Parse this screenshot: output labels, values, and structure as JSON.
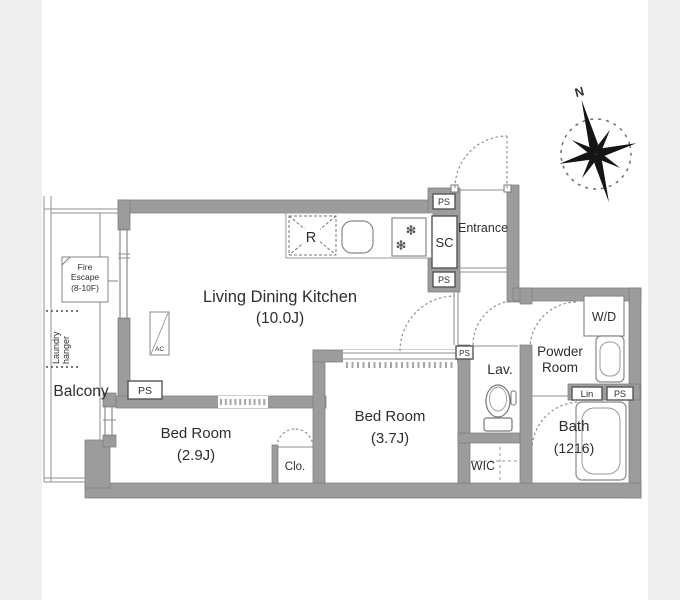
{
  "palette": {
    "page_background": "#efefef",
    "canvas_background": "#ffffff",
    "wall_gray": "#9c9c9c",
    "line_gray": "#8f8f8f",
    "text_color": "#2e2e2e"
  },
  "rooms": {
    "ldk": {
      "name": "Living Dining Kitchen",
      "size": "(10.0J)"
    },
    "bedroom_main": {
      "name": "Bed Room",
      "size": "(3.7J)"
    },
    "bedroom_second": {
      "name": "Bed Room",
      "size": "(2.9J)"
    },
    "bath": {
      "name": "Bath",
      "size": "(1216)"
    },
    "powder_room": {
      "line1": "Powder",
      "line2": "Room"
    },
    "lavatory": {
      "name": "Lav."
    },
    "walk_in_closet": {
      "name": "WIC"
    },
    "closet": {
      "name": "Clo."
    },
    "shoe_closet": {
      "name": "SC"
    },
    "entrance": {
      "name": "Entrance"
    },
    "balcony": {
      "name": "Balcony"
    }
  },
  "labels": {
    "pipe_space": "PS",
    "washer_dryer": "W/D",
    "refrigerator": "R",
    "air_conditioner": "AC",
    "linen": "Lin",
    "north": "N"
  },
  "annotations": {
    "fire_escape": {
      "line1": "Fire",
      "line2": "Escape",
      "line3": "(8-10F)"
    },
    "laundry_hanger": {
      "line1": "Laundry",
      "line2": "hanger"
    }
  }
}
